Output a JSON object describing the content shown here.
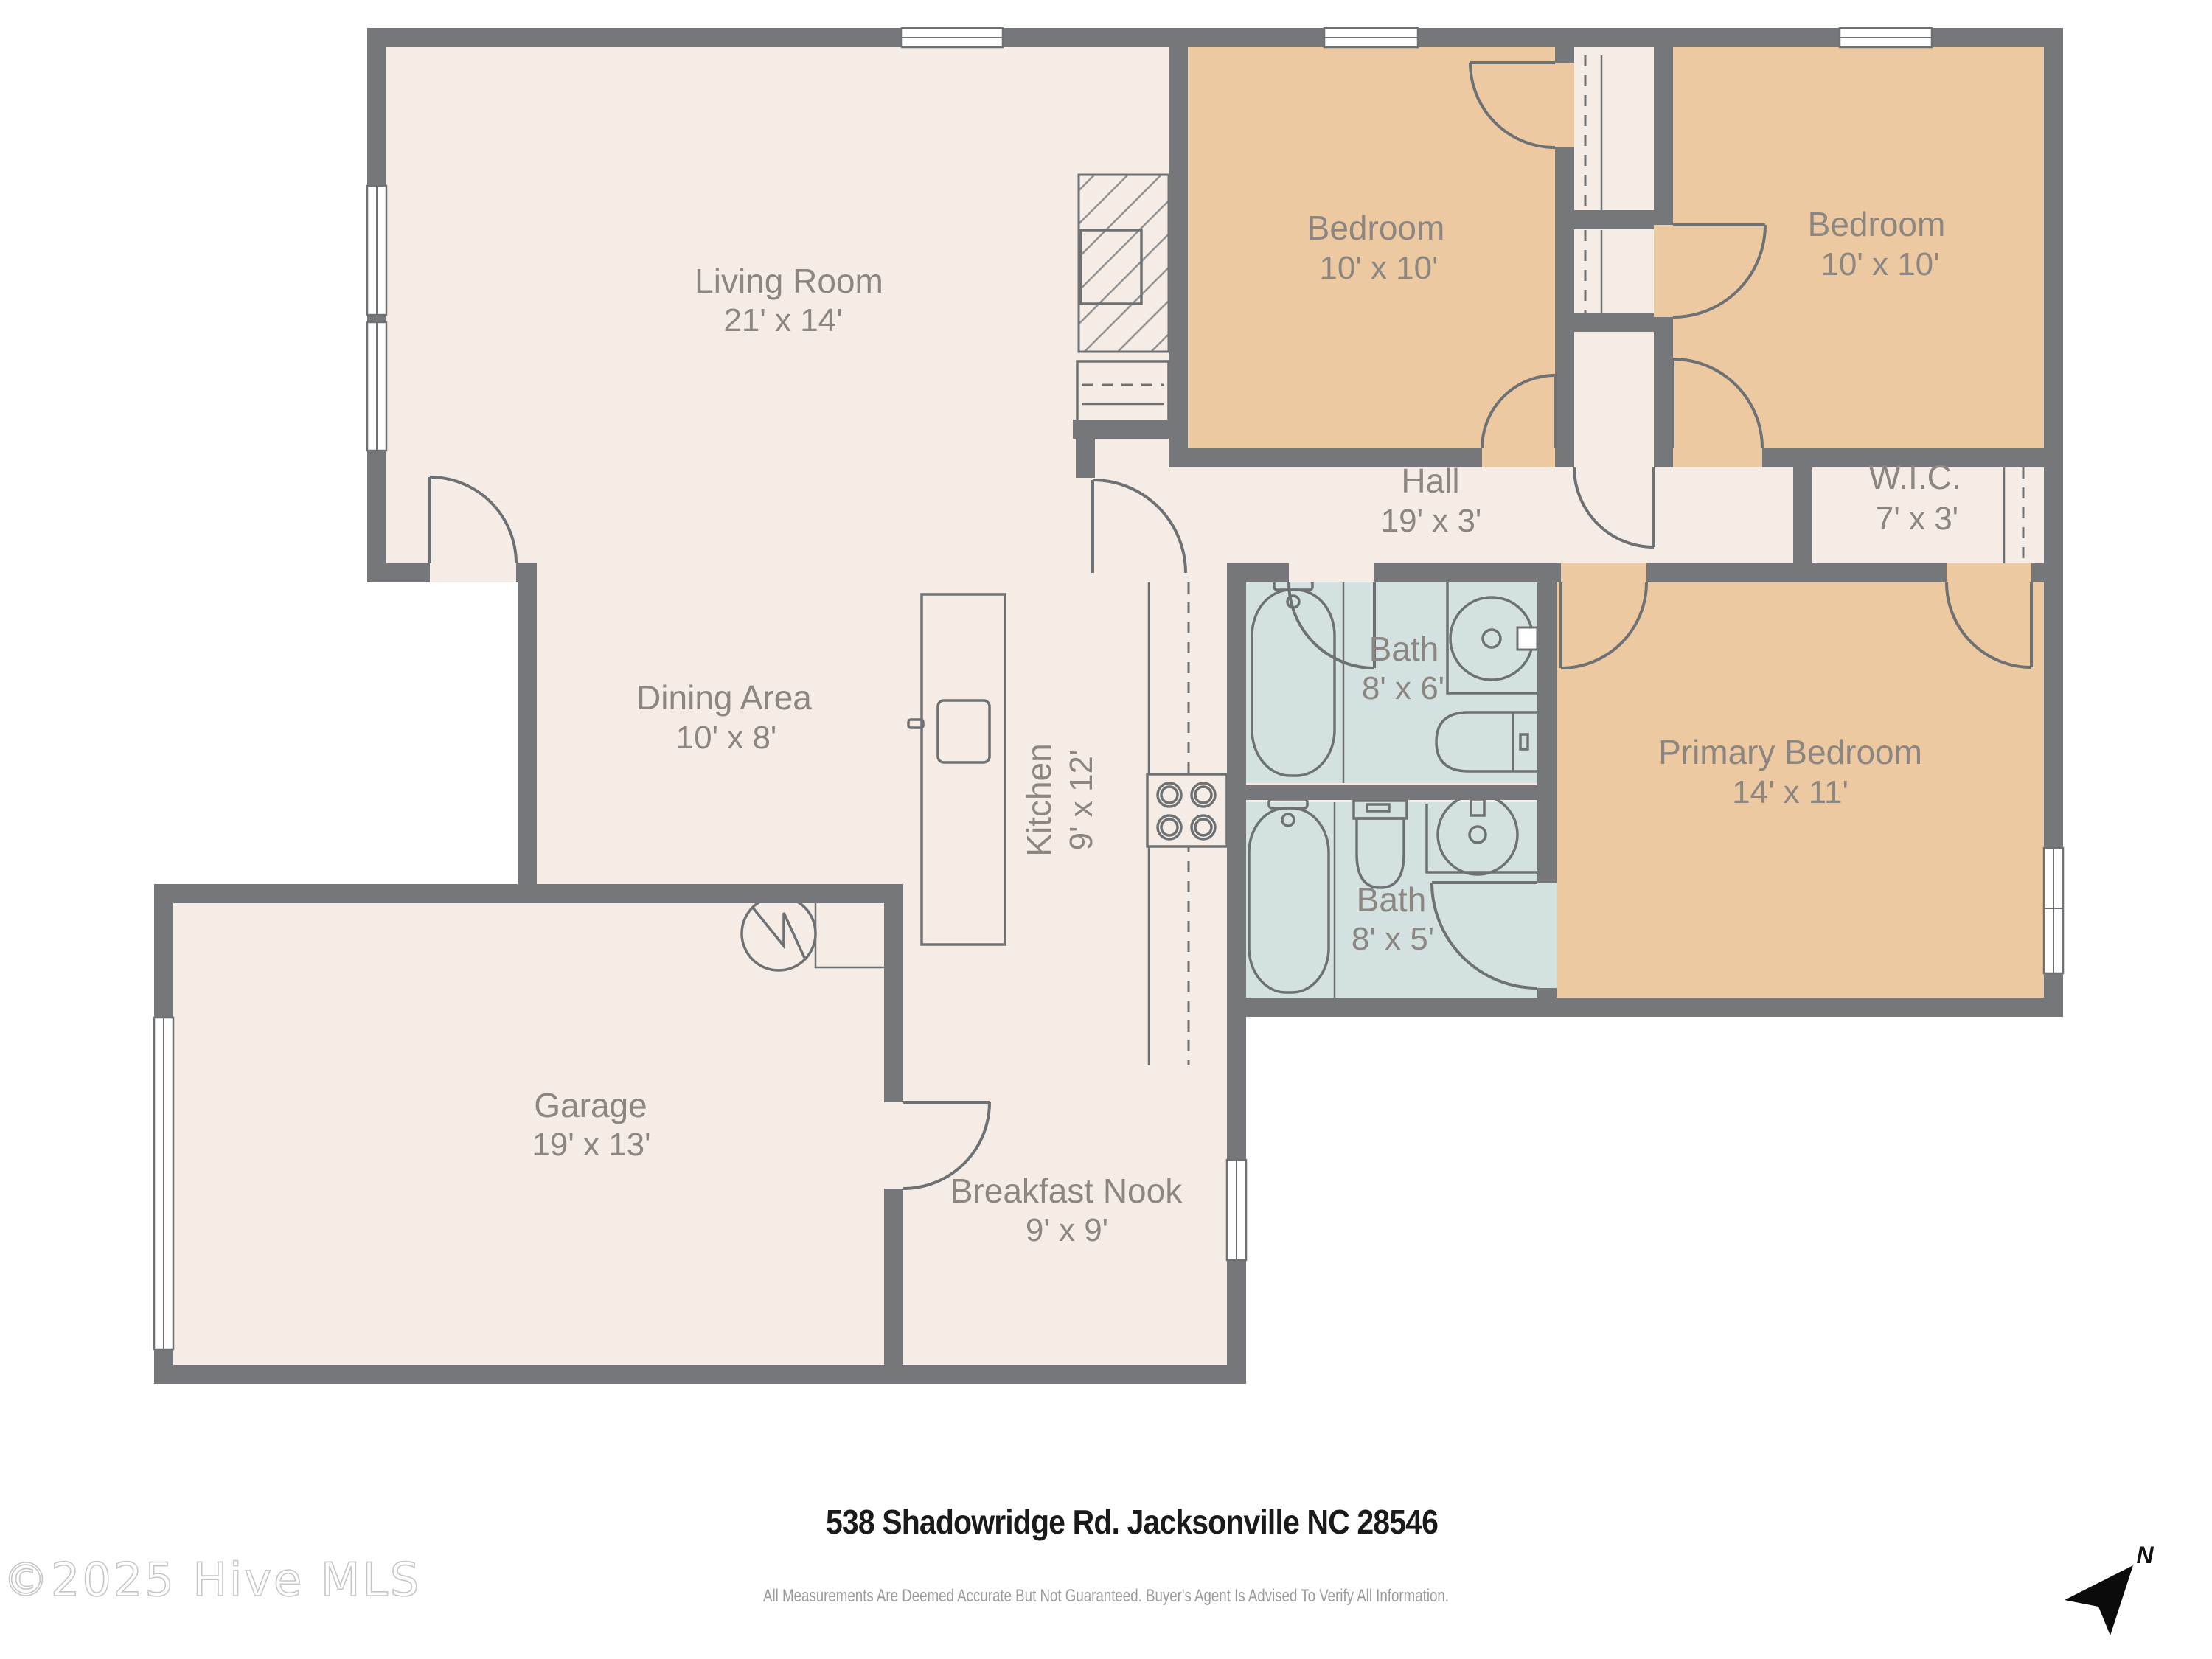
{
  "plan": {
    "rooms": {
      "living": {
        "name": "Living Room",
        "dims": "21' x 14'"
      },
      "bedroom_a": {
        "name": "Bedroom",
        "dims": "10' x 10'"
      },
      "bedroom_b": {
        "name": "Bedroom",
        "dims": "10' x 10'"
      },
      "hall": {
        "name": "Hall",
        "dims": "19' x 3'"
      },
      "wic": {
        "name": "W.I.C.",
        "dims": "7' x 3'"
      },
      "dining": {
        "name": "Dining Area",
        "dims": "10' x 8'"
      },
      "kitchen": {
        "name": "Kitchen",
        "dims": "9' x 12'"
      },
      "bath_a": {
        "name": "Bath",
        "dims": "8' x 6'"
      },
      "bath_b": {
        "name": "Bath",
        "dims": "8' x 5'"
      },
      "primary": {
        "name": "Primary Bedroom",
        "dims": "14' x 11'"
      },
      "garage": {
        "name": "Garage",
        "dims": "19' x 13'"
      },
      "nook": {
        "name": "Breakfast Nook",
        "dims": "9' x 9'"
      }
    },
    "compass": {
      "north_label": "N"
    }
  },
  "footer": {
    "address": "538 Shadowridge Rd. Jacksonville NC 28546",
    "watermark": "©2025 Hive MLS",
    "disclaimer": "All Measurements Are Deemed Accurate But Not Guaranteed. Buyer's Agent Is Advised To Verify All Information."
  },
  "colors": {
    "floor": "#f5ece5",
    "bedroom": "#edc9a2",
    "bath": "#d3e2e0",
    "wall": "#75777a",
    "fixture": "#6e7173",
    "label": "#8b8681",
    "ink": "#1a1a1a",
    "muted": "#9b9b9b",
    "watermark": "#c6c6c6"
  }
}
